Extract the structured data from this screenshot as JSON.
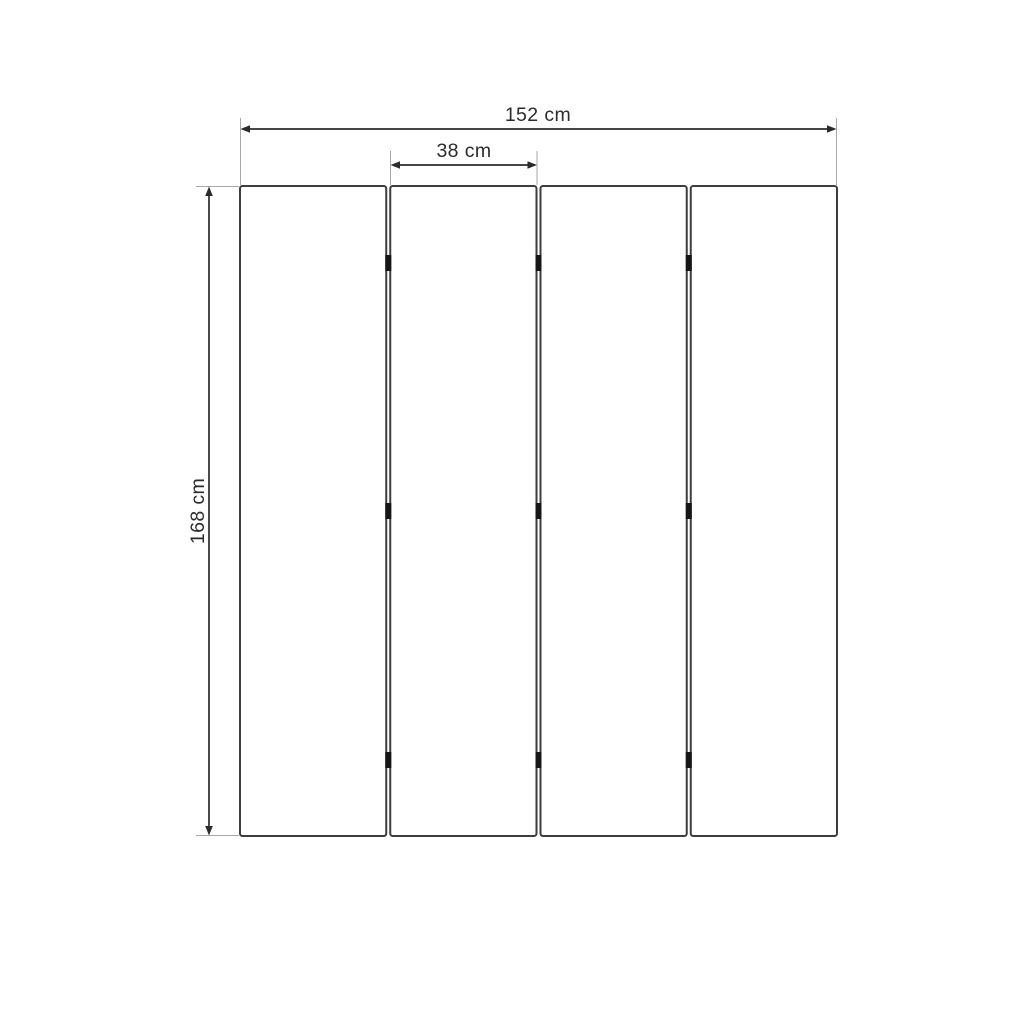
{
  "diagram": {
    "panel_count": 4,
    "hinge_count": 9,
    "labels": {
      "total_width": "152 cm",
      "panel_width": "38 cm",
      "height": "168 cm"
    },
    "values": {
      "total_width_cm": 152,
      "panel_width_cm": 38,
      "height_cm": 168,
      "unit": "cm"
    },
    "colors": {
      "background": "#ffffff",
      "panel_fill": "#ffffff",
      "panel_border": "#3d3d3d",
      "dimension": "#2b2b2b",
      "extension": "#a8a8a8",
      "hinge": "#161616"
    }
  }
}
